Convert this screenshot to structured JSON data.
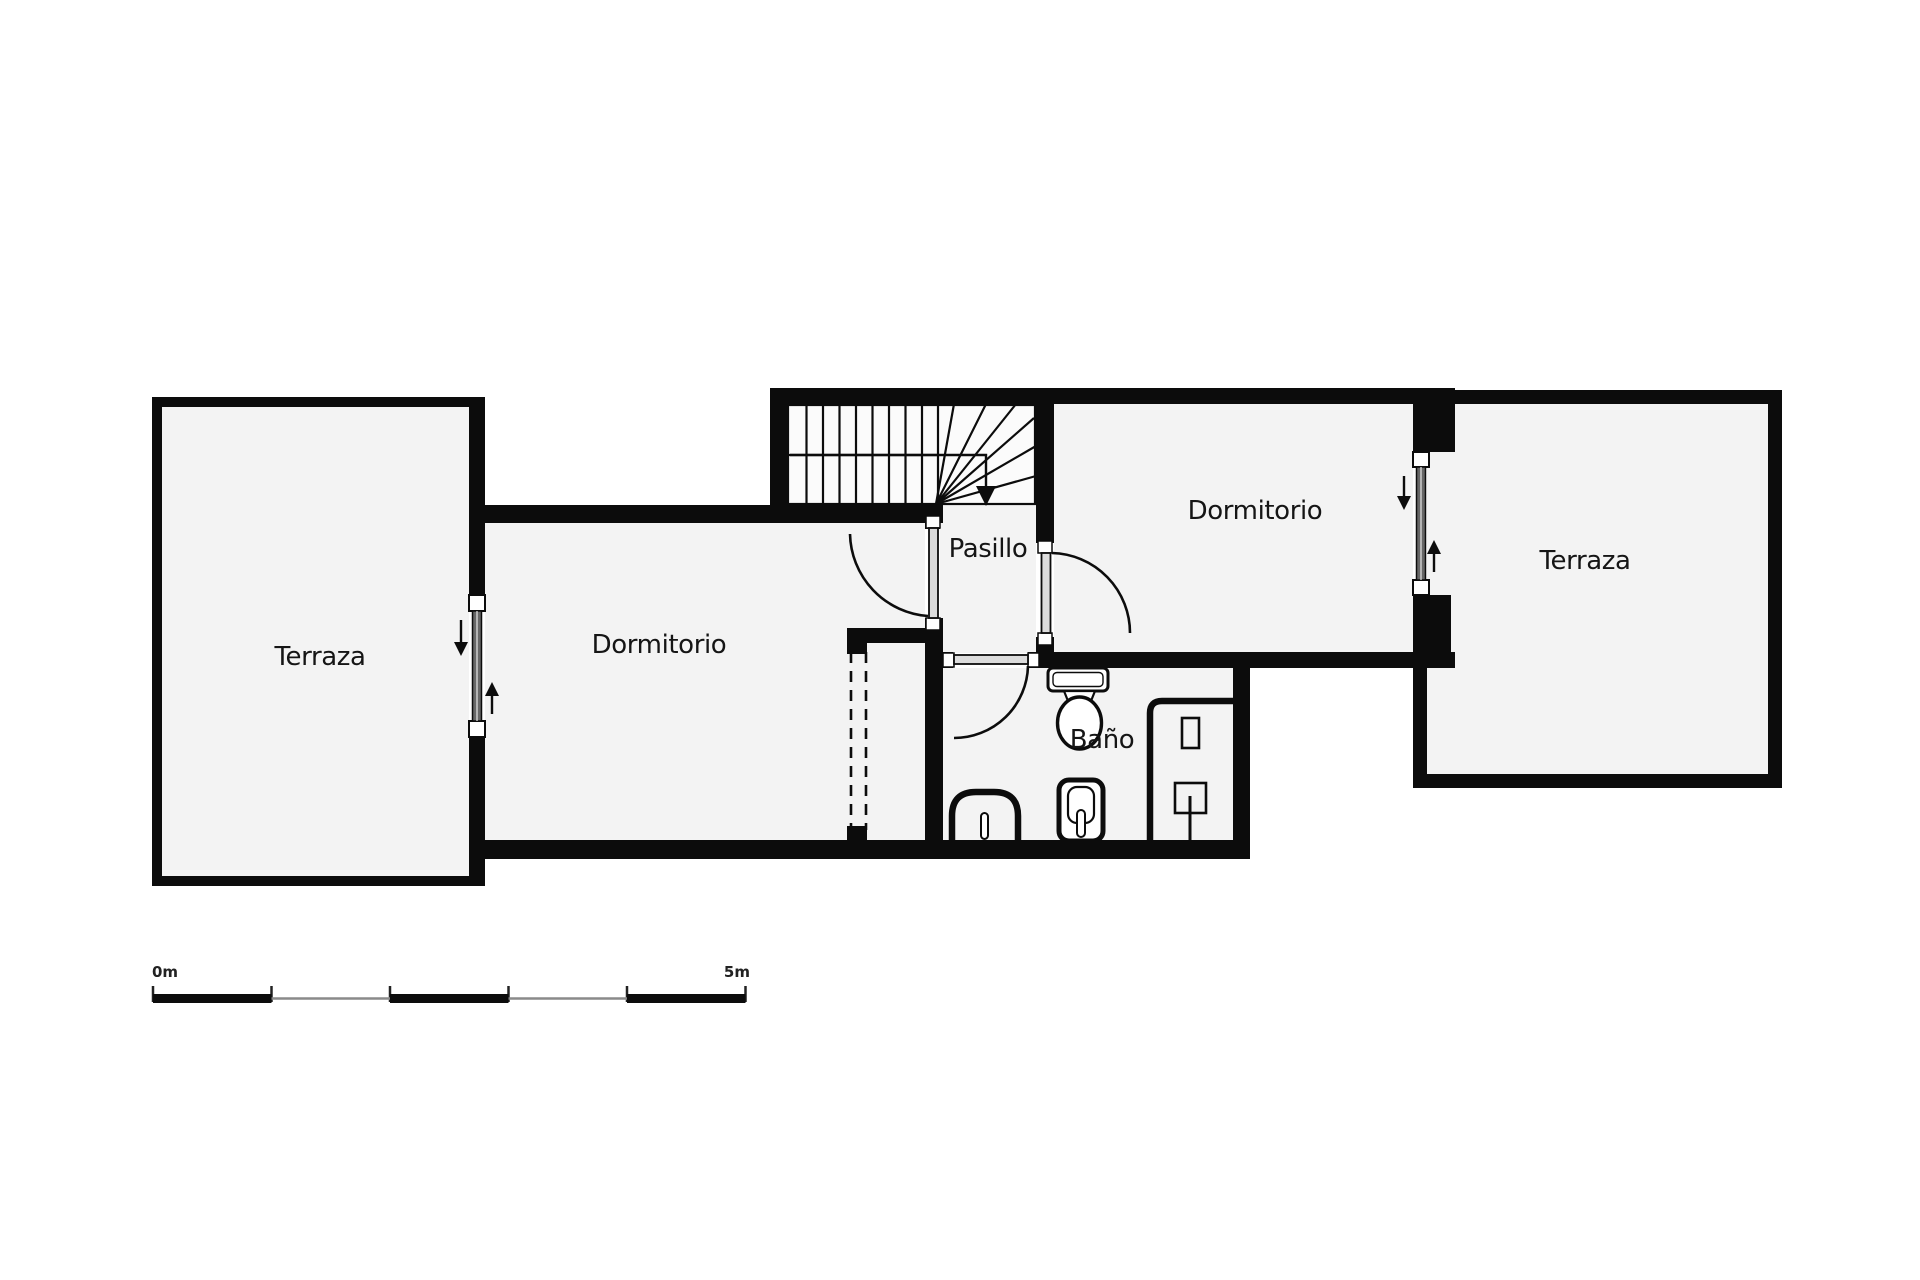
{
  "rooms": {
    "terraza_left": {
      "label": "Terraza"
    },
    "dormitorio_left": {
      "label": "Dormitorio"
    },
    "pasillo": {
      "label": "Pasillo"
    },
    "dormitorio_right": {
      "label": "Dormitorio"
    },
    "terraza_right": {
      "label": "Terraza"
    },
    "bano": {
      "label": "Baño"
    }
  },
  "scale_bar": {
    "start_label": "0m",
    "end_label": "5m",
    "segments": 5
  },
  "colors": {
    "ink": "#0c0c0c",
    "room_fill": "#f3f3f3",
    "stair_fill": "#fbfbfb",
    "glass": "#666666",
    "muted_segment": "#8a8a8a",
    "background": "#ffffff"
  },
  "symbols": {
    "staircase": "staircase-with-down-arrow",
    "doors": [
      "bedroom-left-door",
      "bedroom-right-door",
      "bathroom-door"
    ],
    "windows": [
      "terrace-left-window",
      "terrace-right-window"
    ],
    "fixtures": [
      "toilet",
      "washbasin",
      "bidet",
      "shower"
    ],
    "wardrobe": "dashed-front-wardrobe"
  }
}
